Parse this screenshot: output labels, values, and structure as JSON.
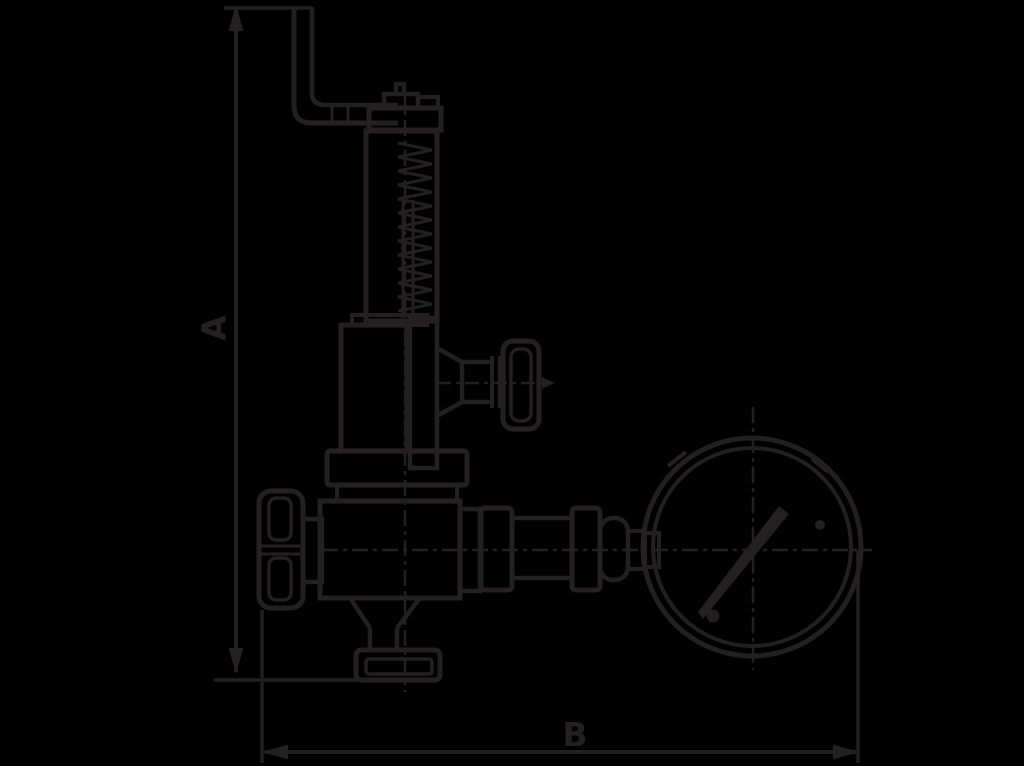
{
  "colors": {
    "background": "#000000",
    "ink": "#241F21"
  },
  "drawing": {
    "dimension_labels": {
      "vertical": "A",
      "horizontal": "B"
    }
  }
}
